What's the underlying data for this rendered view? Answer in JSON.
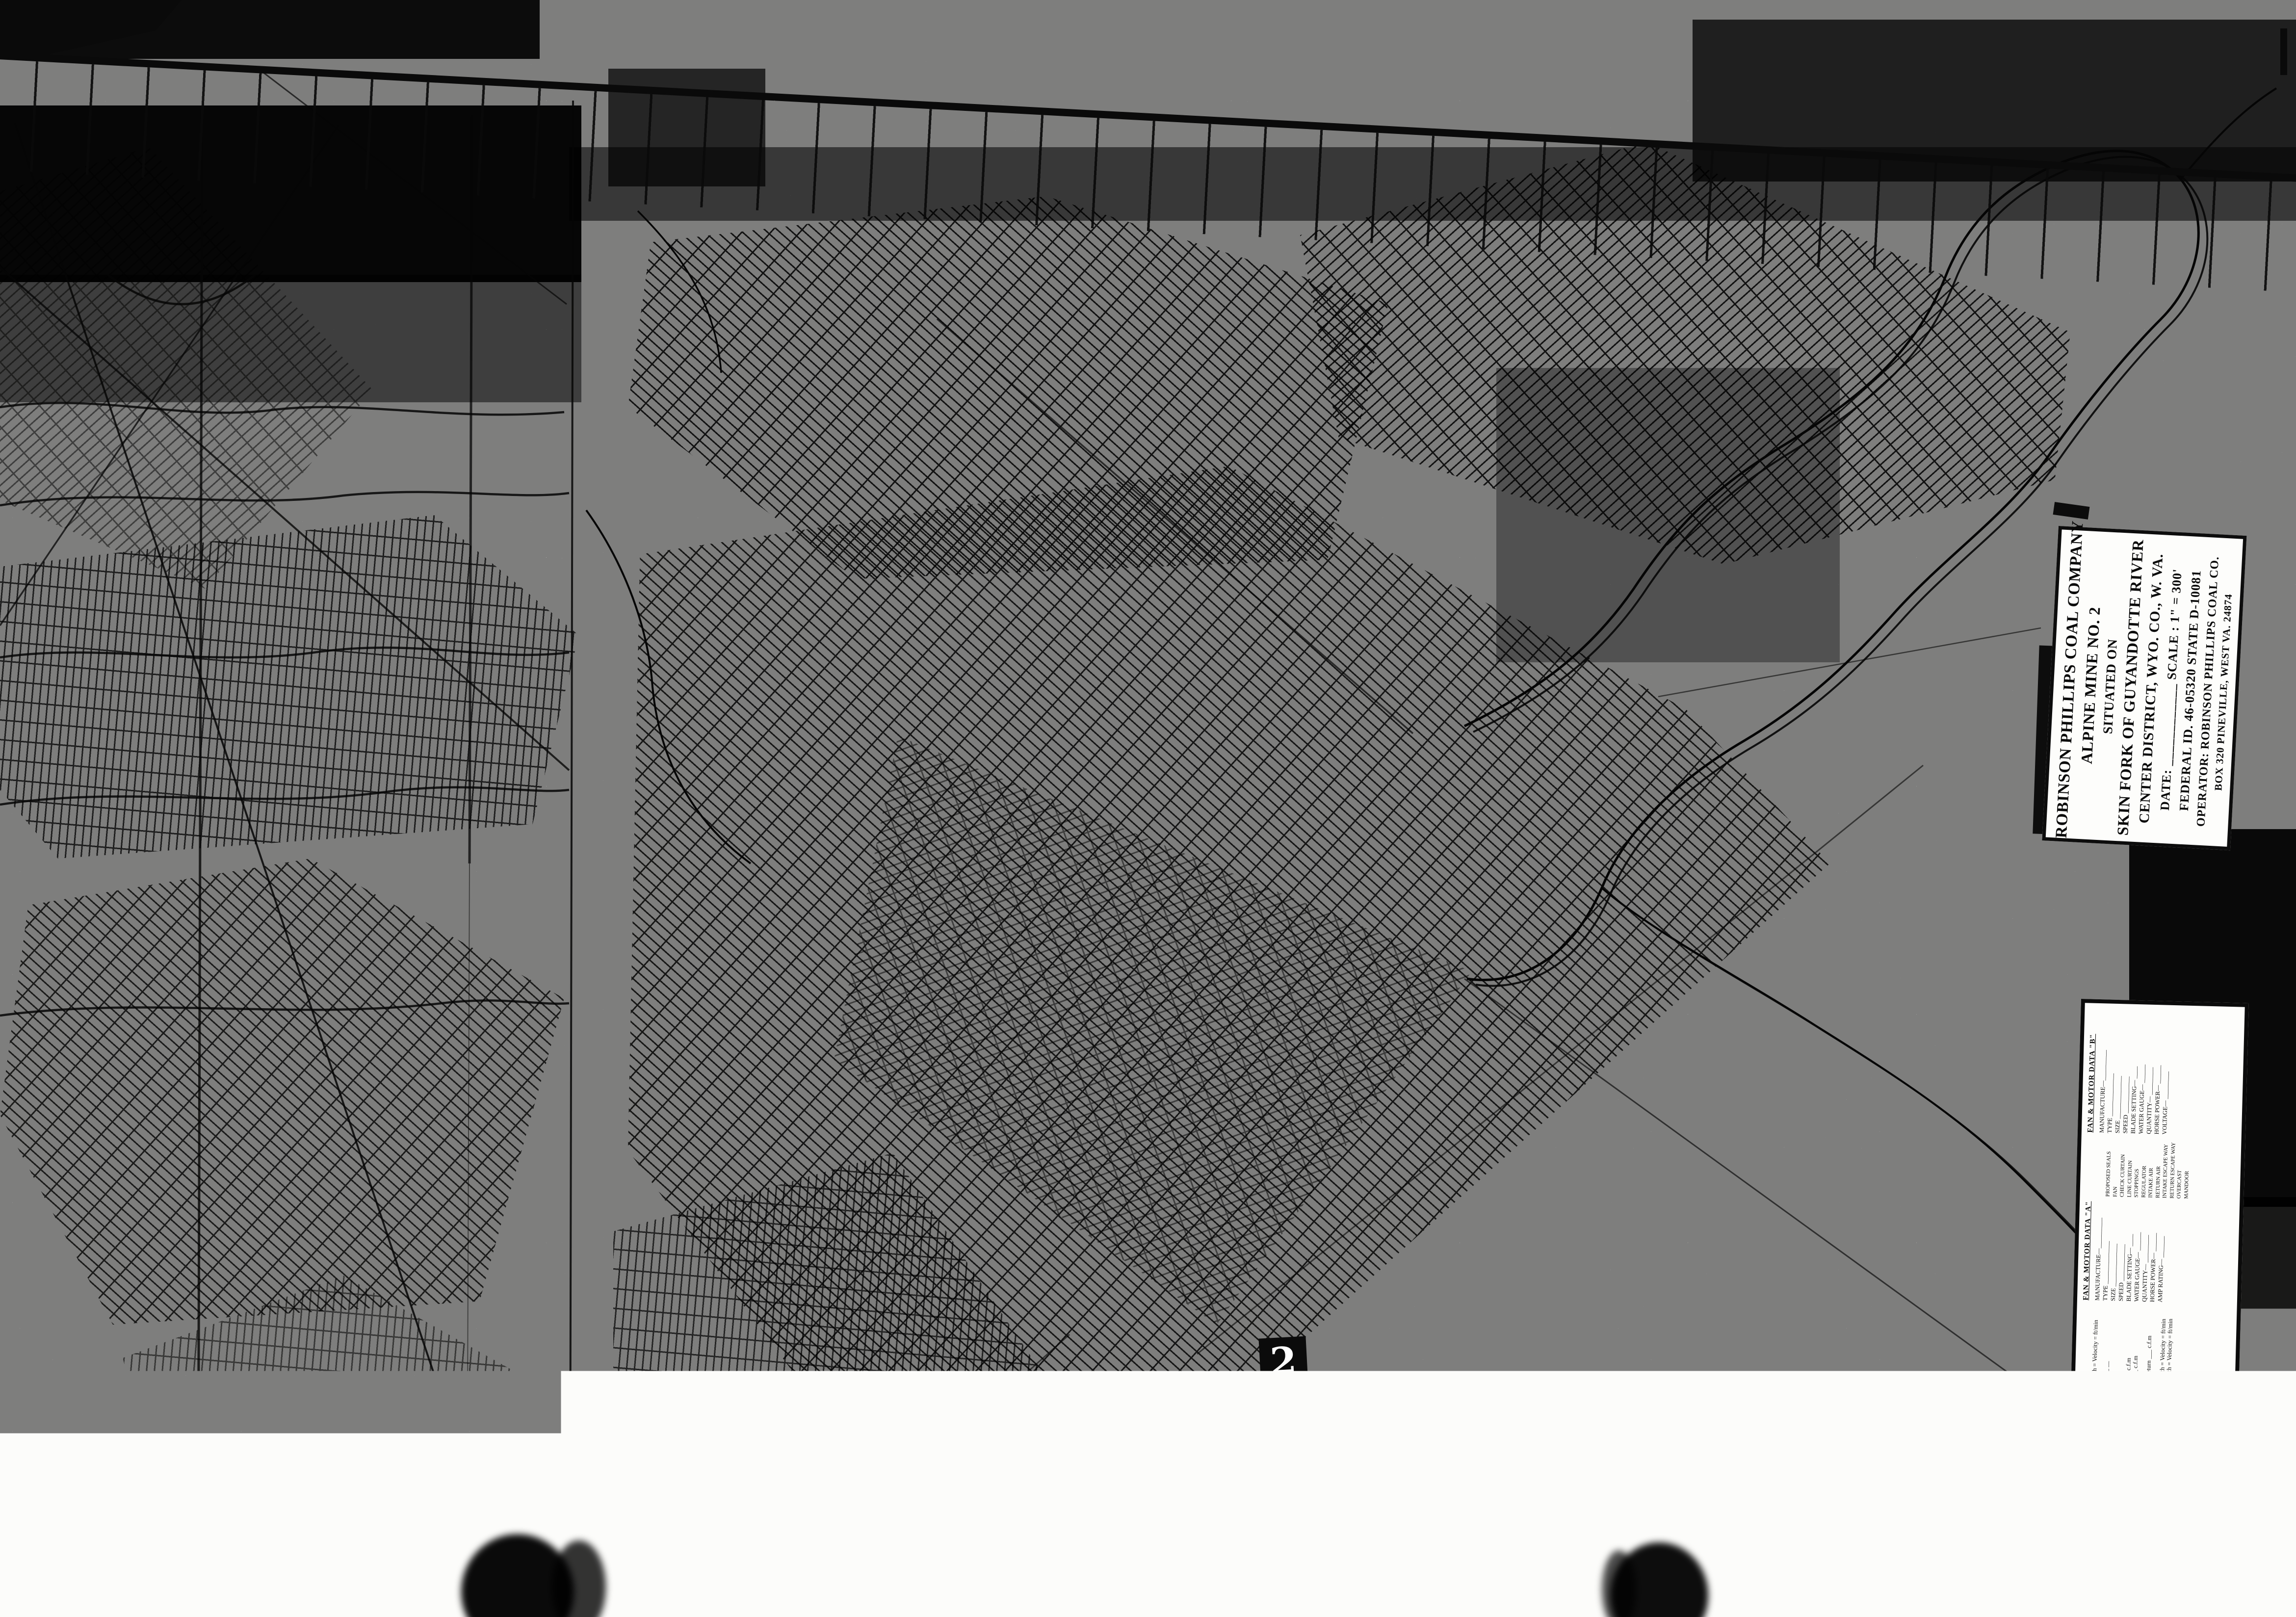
{
  "document": {
    "kind": "scanned mine map microfilm frame",
    "frame_marker": "2",
    "film_strip": {
      "prefix": "WVDM",
      "codes": [
        "03189",
        "30",
        "36X",
        "368817"
      ]
    }
  },
  "title_block": {
    "lines": [
      "ROBINSON PHILLIPS COAL COMPANY",
      "ALPINE MINE NO. 2",
      "SITUATED ON",
      "SKIN FORK OF GUYANDOTTE RIVER",
      "CENTER DISTRICT, WYO. CO., W. VA.",
      "DATE: ____________   SCALE : 1\" = 300'",
      "FEDERAL ID. 46-05320    STATE D-10081",
      "OPERATOR:  ROBINSON PHILLIPS COAL CO.",
      "BOX 320   PINEVILLE, WEST VA. 24874"
    ]
  },
  "legend": {
    "title": "LEGEND",
    "fan_motor_b": {
      "title": "FAN & MOTOR DATA \"B\"",
      "rows": [
        "MANUFACTURE—__________",
        "TYPE ______________",
        "SIZE ______________",
        "SPEED ____________",
        "BLADE SETTING— ____",
        "WATER GAUGE— ______",
        "QUANTITY— _________",
        "HORSE POWER— ______",
        "VOLTAGE— _________"
      ]
    },
    "fan_motor_a": {
      "title": "FAN & MOTOR DATA \"A\"",
      "rows": [
        "MANUFACTURE—__________",
        "TYPE ______________",
        "SIZE ______________",
        "SPEED ____________",
        "BLADE SETTING— ____",
        "WATER GAUGE— ______",
        "QUANTITY— _________",
        "HORSE POWER— ______",
        "AMP RATING— _______"
      ]
    },
    "symbols": [
      "PROPOSED SEALS",
      "FAN",
      "CHECK CURTAIN",
      "LINE CURTAIN",
      "STOPPINGS",
      "REGULATOR",
      "INTAKE AIR",
      "RETURN AIR",
      "INTAKE ESCAPE WAY",
      "RETURN ESCAPE WAY",
      "OVERCAST",
      "MANDOOR"
    ],
    "items": [
      "No 1  Air @ Belt Entry  Height =     Width =     Velocity =      ft/min",
      "No 2  Proposed Emergency Seals",
      "No 3  Air Reading At Box Check  — — —",
      "No 4  Intake Air ____________ c.f.m",
      "No 5  Intake Air ____________ c.f.m",
      "No 6  Air Reading At The Fan ______ c.f.m",
      "No 7  Belt Regulator Air Reading ____ c.f.m",
      "No 8  Evaluation At Left Side Return",
      "No 9  Last Open Crosscut Left Side Return ___ c.f.m",
      "No 10  Return ______________ c.f.m",
      "No 11  Air @ Belt Entry Height =  Width =  Velocity =  ft/min",
      "No 12  Air @ Belt Entry Height =  Width =  Velocity =  ft/min",
      "No 13  Regulator ___________ c.f.m",
      "No 14  ______________",
      "No 15  ______________",
      "No 16  ______________",
      "No 17  Fan \"H\"",
      "No 18  Return Air",
      "No 19  ______________"
    ]
  }
}
